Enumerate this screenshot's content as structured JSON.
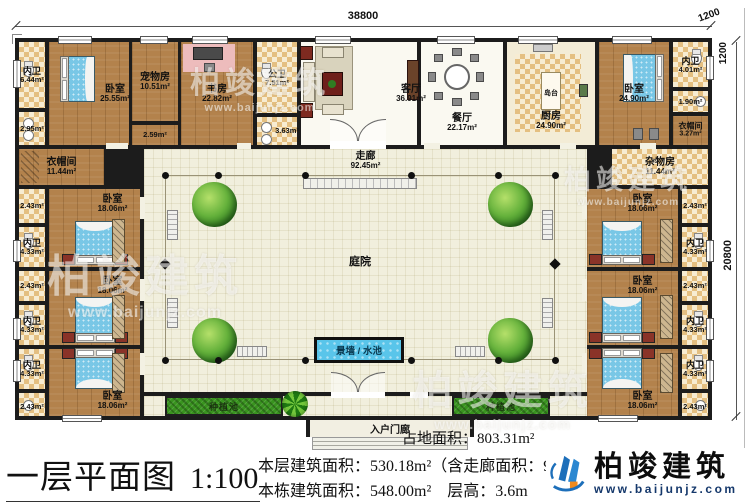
{
  "dims": {
    "total_width": "38800",
    "total_height": "20800",
    "offset_h": "1200",
    "offset_v": "1200"
  },
  "top_row": {
    "wc1": {
      "label": "内卫",
      "area": "6.44m²"
    },
    "small1": {
      "area": "2.95m²"
    },
    "bedroom_left": {
      "label": "卧室",
      "area": "25.55m²"
    },
    "pet_room": {
      "label": "宠物房",
      "area": "10.51m²"
    },
    "pet_small": {
      "area": "2.59m²"
    },
    "study": {
      "label": "书房",
      "area": "22.82m²"
    },
    "public_wc": {
      "label": "公卫",
      "area": "7.51m²"
    },
    "public_wc_small": {
      "area": "3.63m²"
    },
    "living": {
      "label": "客厅",
      "area": "36.91m²"
    },
    "dining": {
      "label": "餐厅",
      "area": "22.17m²"
    },
    "kitchen": {
      "label": "厨房",
      "area": "24.90m²"
    },
    "island": {
      "label": "岛台"
    },
    "bedroom_right": {
      "label": "卧室",
      "area": "24.90m²"
    },
    "wc2": {
      "label": "内卫",
      "area": "4.01m²"
    },
    "small2": {
      "area": "1.90m²"
    },
    "cloak_small": {
      "label": "衣帽间",
      "area": "3.27m²"
    }
  },
  "left_wing": {
    "cloak": {
      "label": "衣帽间",
      "area": "11.44m²"
    },
    "suites": [
      {
        "bedroom_label": "卧室",
        "bedroom_area": "18.06m²",
        "closet_area": "2.43m²",
        "wc_label": "内卫",
        "wc_area": "4.33m²"
      },
      {
        "bedroom_label": "卧室",
        "bedroom_area": "18.06m²",
        "closet_area": "2.43m²",
        "wc_label": "内卫",
        "wc_area": "4.33m²"
      },
      {
        "bedroom_label": "卧室",
        "bedroom_area": "18.06m²",
        "closet_area": "2.43m²",
        "wc_label": "内卫",
        "wc_area": "4.33m²"
      }
    ]
  },
  "right_wing": {
    "junk": {
      "label": "杂物房",
      "area": "11.44m²"
    },
    "suites": [
      {
        "bedroom_label": "卧室",
        "bedroom_area": "18.06m²",
        "closet_area": "2.43m²",
        "wc_label": "内卫",
        "wc_area": "4.33m²"
      },
      {
        "bedroom_label": "卧室",
        "bedroom_area": "18.06m²",
        "closet_area": "2.43m²",
        "wc_label": "内卫",
        "wc_area": "4.33m²"
      },
      {
        "bedroom_label": "卧室",
        "bedroom_area": "18.06m²",
        "closet_area": "2.43m²",
        "wc_label": "内卫",
        "wc_area": "4.33m²"
      }
    ]
  },
  "center": {
    "corridor": {
      "label": "走廊",
      "area": "92.45m²"
    },
    "courtyard": {
      "label": "庭院"
    },
    "pool": {
      "label": "景墙 / 水池"
    },
    "planter_left": {
      "label": "种植池"
    },
    "planter_right": {
      "label": "种植池"
    },
    "porch": {
      "label": "入户门廊"
    }
  },
  "footer": {
    "title": "一层平面图",
    "scale": "1:100",
    "land_area": "占地面积：803.31m²",
    "floor_area": "本层建筑面积：530.18m²（含走廊面积：92",
    "building_area": "本栋建筑面积：548.00m²",
    "floor_height": "层高：3.6m",
    "brand": "柏竣建筑",
    "website": "www.baijunjz.com"
  },
  "watermark": {
    "brand": "柏竣建筑",
    "website": "www.baijunjz.com"
  }
}
